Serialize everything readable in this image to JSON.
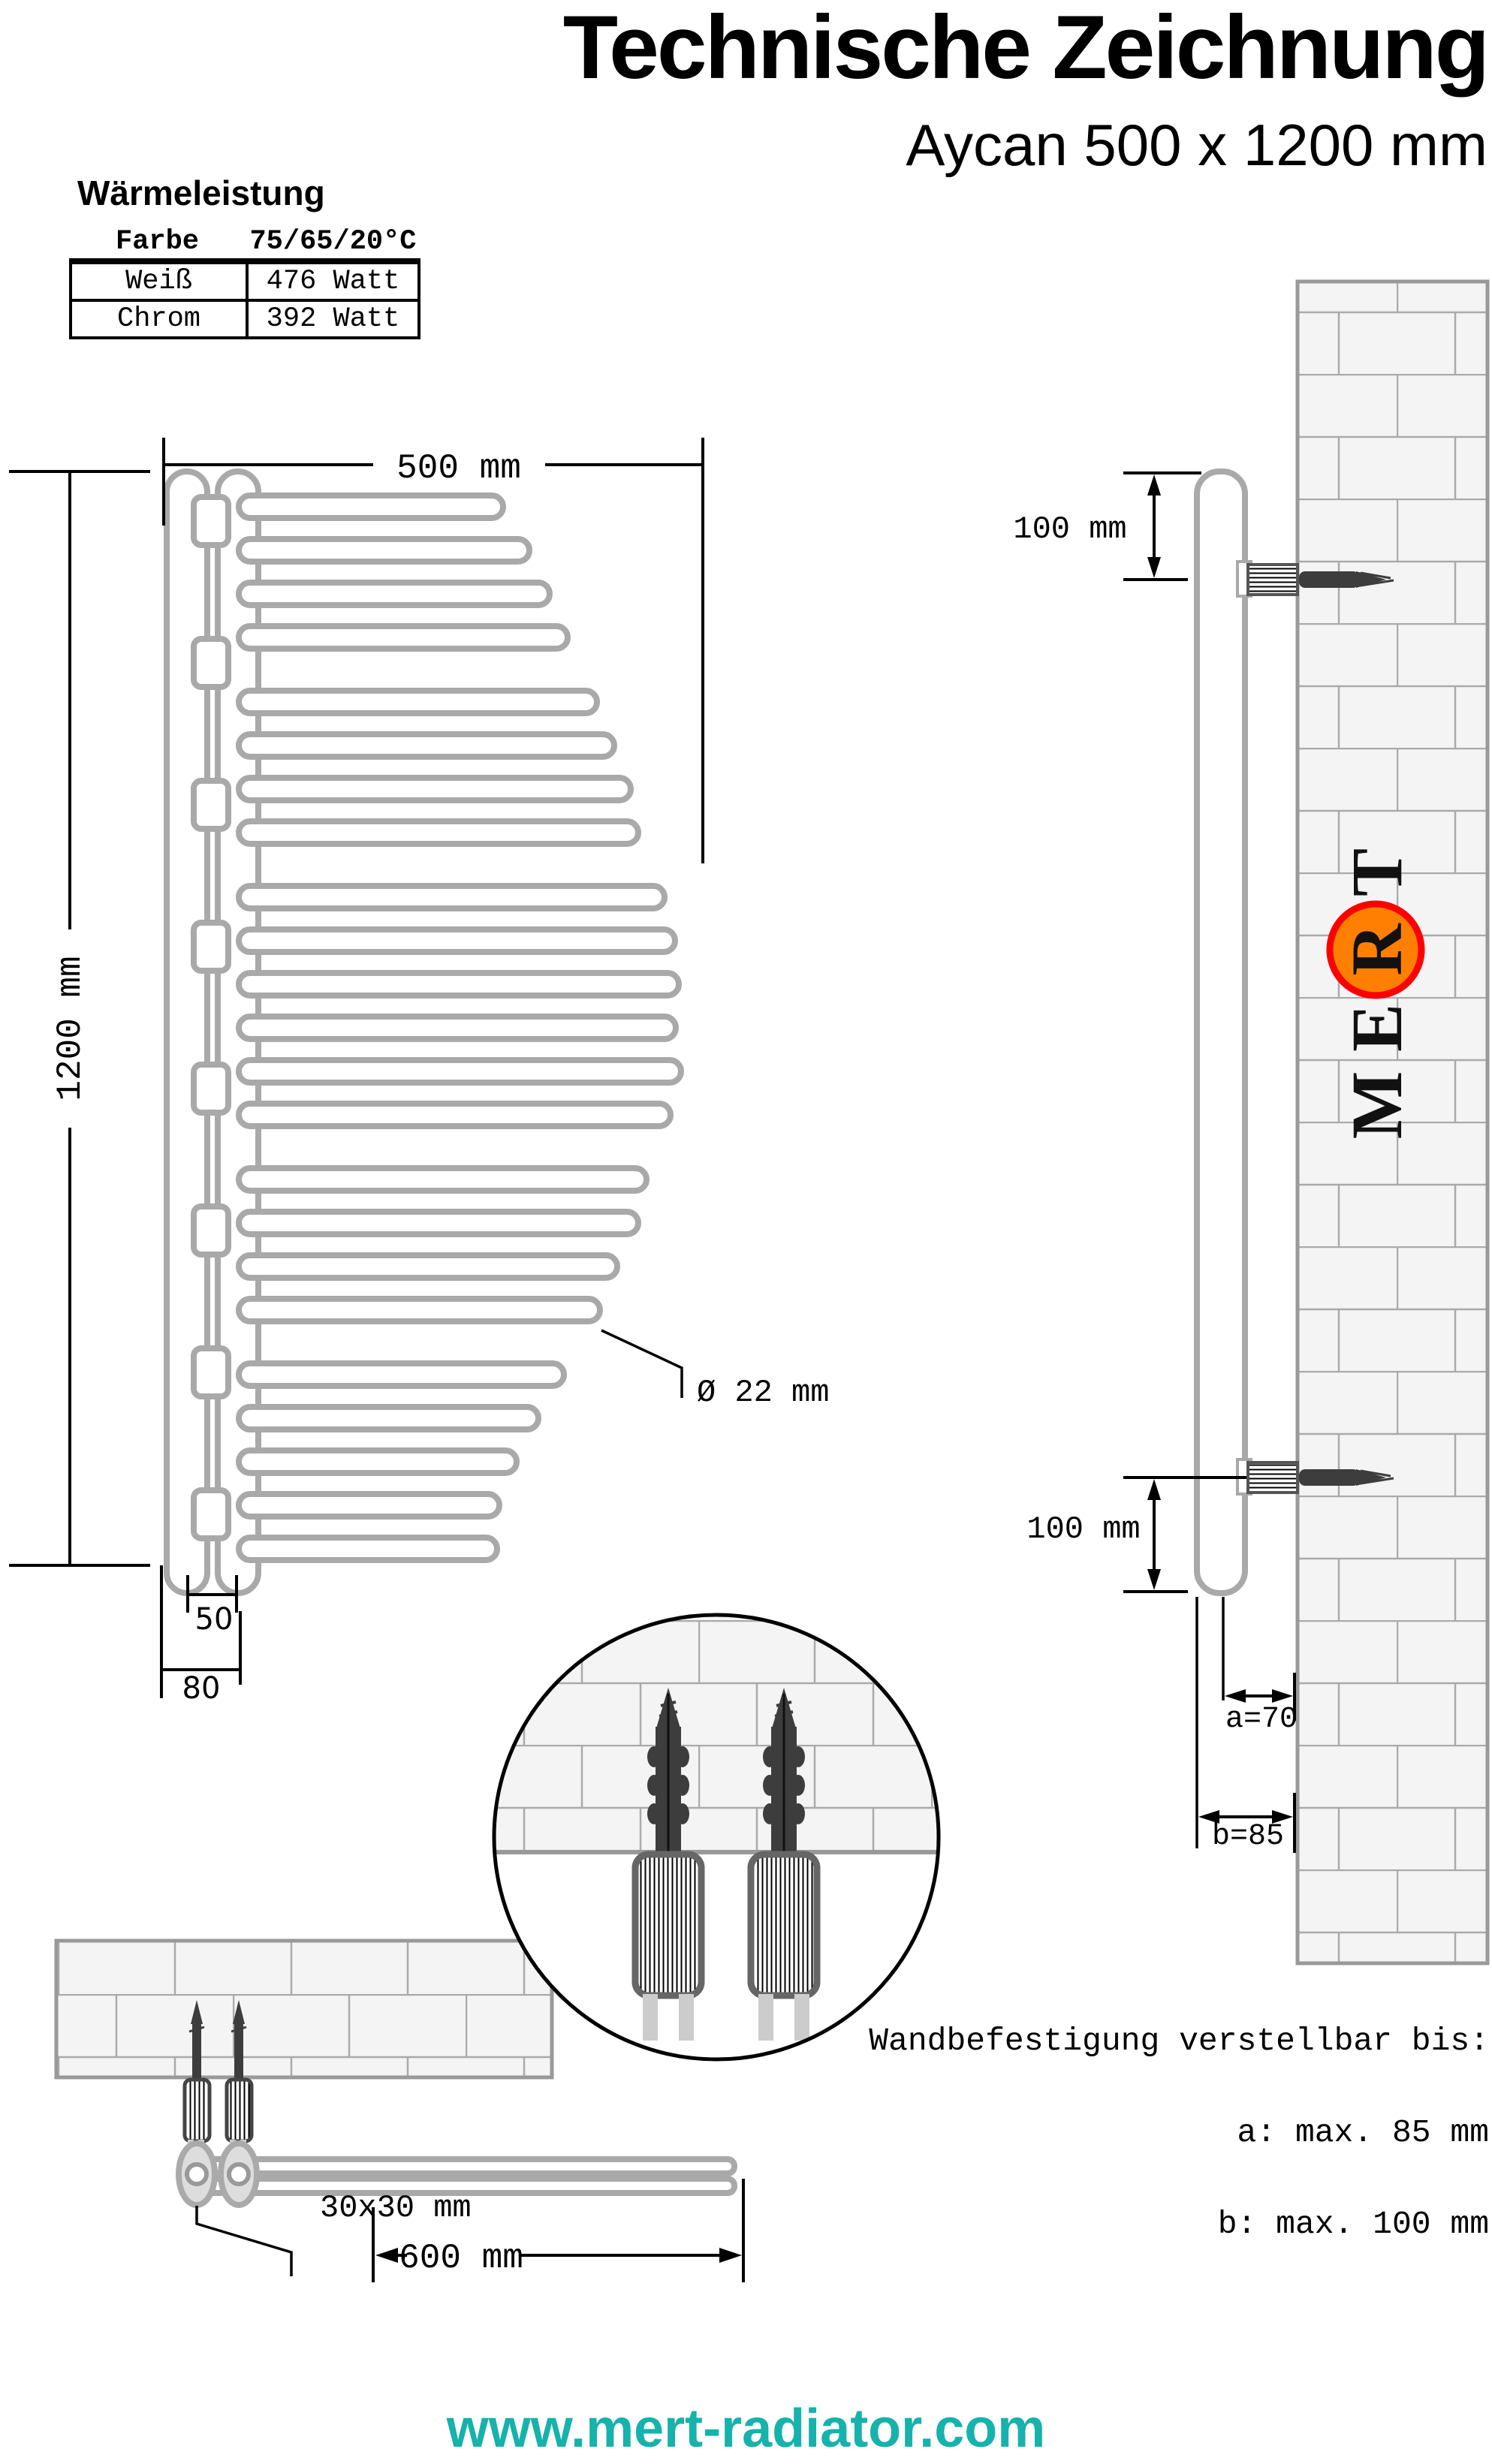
{
  "header": {
    "title": "Technische Zeichnung",
    "subtitle": "Aycan 500 x 1200 mm"
  },
  "heat_output": {
    "heading": "Wärmeleistung",
    "columns": [
      "Farbe",
      "75/65/20°C"
    ],
    "rows": [
      [
        "Weiß",
        "476 Watt"
      ],
      [
        "Chrom",
        "392 Watt"
      ]
    ]
  },
  "front_view": {
    "width_label": "500 mm",
    "height_label": "1200 mm",
    "tube_diameter_label": "Ø 22 mm",
    "tube_spacing_label": "50",
    "depth_label": "80",
    "bars": [
      [
        660,
        670
      ],
      [
        718,
        705
      ],
      [
        776,
        732
      ],
      [
        834,
        756
      ],
      [
        920,
        795
      ],
      [
        978,
        818
      ],
      [
        1036,
        840
      ],
      [
        1094,
        850
      ],
      [
        1180,
        885
      ],
      [
        1238,
        899
      ],
      [
        1296,
        904
      ],
      [
        1354,
        900
      ],
      [
        1412,
        907
      ],
      [
        1470,
        893
      ],
      [
        1556,
        861
      ],
      [
        1614,
        850
      ],
      [
        1672,
        822
      ],
      [
        1730,
        799
      ],
      [
        1816,
        751
      ],
      [
        1874,
        717
      ],
      [
        1932,
        688
      ],
      [
        1990,
        665
      ],
      [
        2048,
        662
      ]
    ],
    "stub_ys": [
      662,
      851,
      1040,
      1229,
      1418,
      1607,
      1796,
      1985
    ]
  },
  "side_view": {
    "top_offset_label": "100 mm",
    "bottom_offset_label": "100 mm",
    "wall_distance_a_label": "a=70",
    "wall_distance_b_label": "b=85"
  },
  "bottom_view": {
    "bracket_size_label": "30x30 mm",
    "mount_width_label": "600 mm"
  },
  "mount_note": {
    "line1": "Wandbefestigung verstellbar bis:",
    "line2": "a: max. 85 mm",
    "line3": "b: max. 100 mm"
  },
  "logo": {
    "letters": [
      "M",
      "E",
      "R",
      "T"
    ],
    "circle_fill": "#ff8000",
    "circle_ring": "#ff0000"
  },
  "footer": {
    "website": "www.mert-radiator.com",
    "color": "#16b2ac"
  }
}
